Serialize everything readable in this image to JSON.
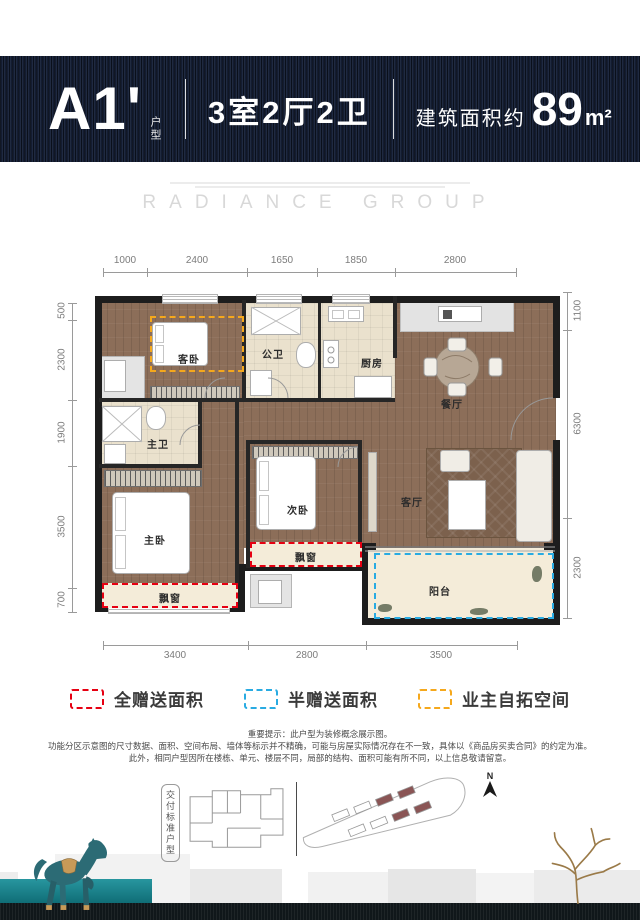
{
  "header": {
    "unit_code": "A1'",
    "unit_type_label": "户型",
    "layout": "3室2厅2卫",
    "area_prefix": "建筑面积约",
    "area_value": "89",
    "area_unit": "m²"
  },
  "watermark": "RADIANCE GROUP",
  "floorplan": {
    "dims_top": [
      "1000",
      "2400",
      "1650",
      "1850",
      "2800"
    ],
    "dims_left": [
      "500",
      "2300",
      "1900",
      "3500",
      "700"
    ],
    "dims_right": [
      "1100",
      "6300",
      "2300"
    ],
    "dims_bottom": [
      "3400",
      "2800",
      "3500"
    ],
    "rooms": {
      "guest_bedroom": "客卧",
      "public_bathroom": "公卫",
      "kitchen": "厨房",
      "dining_room": "餐厅",
      "master_bathroom": "主卫",
      "master_bedroom": "主卧",
      "second_bedroom": "次卧",
      "living_room": "客厅",
      "bay_window_master": "飘窗",
      "bay_window_second": "飘窗",
      "balcony": "阳台"
    }
  },
  "legend": {
    "items": [
      {
        "label": "全赠送面积",
        "color": "#e60012"
      },
      {
        "label": "半赠送面积",
        "color": "#29abe2"
      },
      {
        "label": "业主自拓空间",
        "color": "#f5a81c"
      }
    ]
  },
  "disclaimer": {
    "line1": "重要提示：此户型为装修概念展示图。",
    "line2": "功能分区示意图的尺寸数据、面积、空间布局、墙体等标示并不精确，可能与房屋实际情况存在不一致，具体以《商品房买卖合同》的约定为准。",
    "line3": "此外，相同户型因所在楼栋、单元、楼层不同，局部的结构、面积可能有所不同，以上信息敬请留意。"
  },
  "footer": {
    "standard_label": "交付标准户型",
    "north_label": "N"
  },
  "colors": {
    "header_navy": "#131c31",
    "full_gift_red": "#e60012",
    "half_gift_blue": "#29abe2",
    "owner_expand_orange": "#f5a81c",
    "teal_platform": "#157b84",
    "wood_floor": "#8c6e59"
  }
}
